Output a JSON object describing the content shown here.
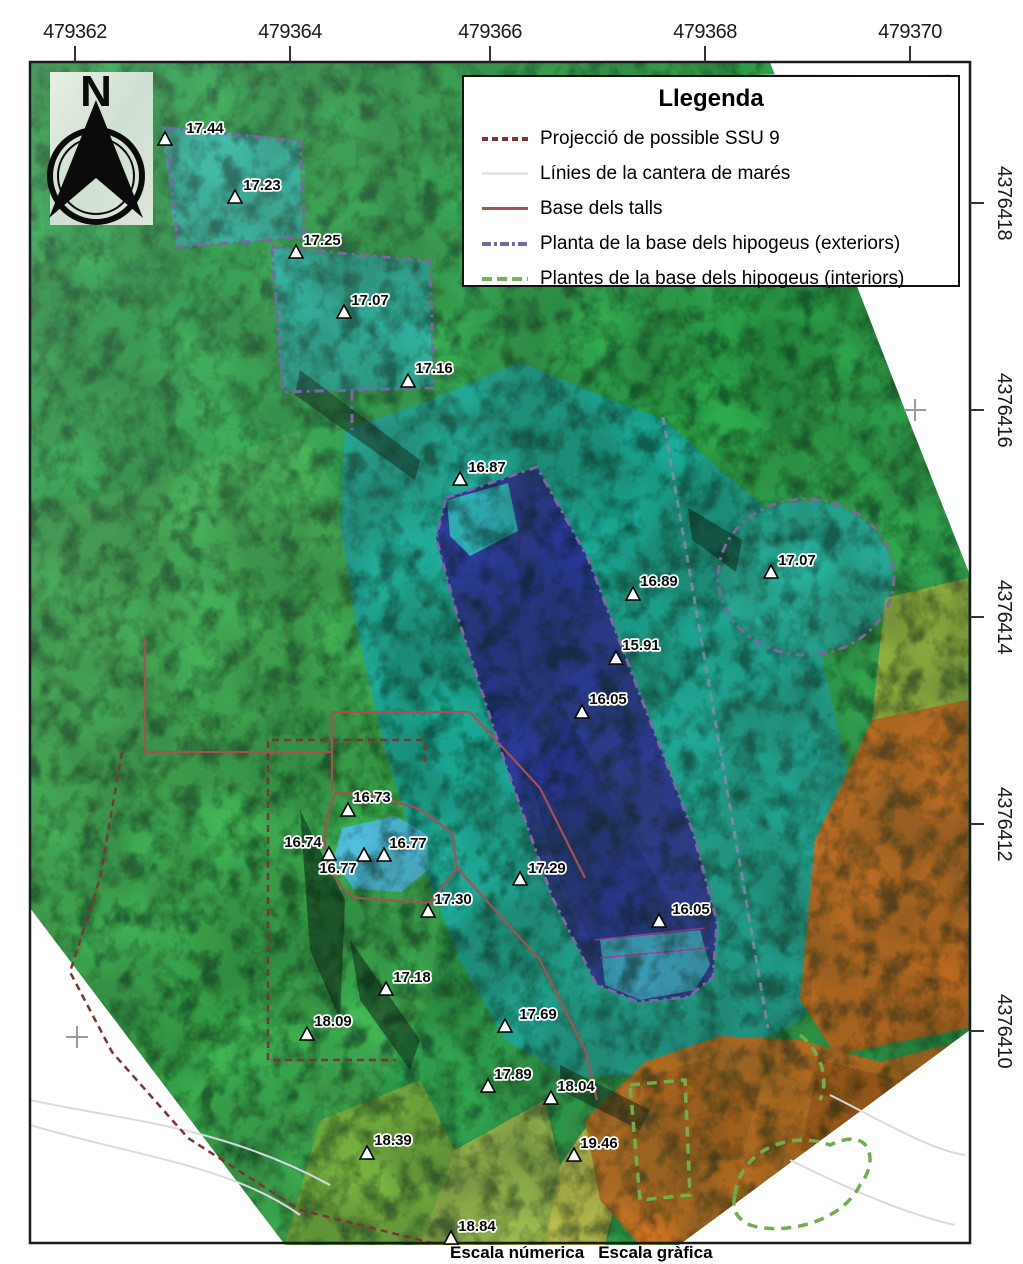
{
  "map": {
    "north_label": "N",
    "caption": {
      "numeric_scale": "Escala númerica",
      "graphic_scale": "Escala gràfica"
    }
  },
  "legend": {
    "title": "Llegenda",
    "items": [
      {
        "label": "Projecció de possible SSU 9",
        "style": "dashed",
        "color": "#7e3434"
      },
      {
        "label": "Línies de la cantera de marés",
        "style": "solid",
        "color": "#e2e2ea"
      },
      {
        "label": "Base dels talls",
        "style": "solid",
        "color": "#a05454"
      },
      {
        "label": "Planta de la base dels hipogeus (exteriors)",
        "style": "dashdot",
        "color": "#7b68a0"
      },
      {
        "label": "Plantes de la base dels hipogeus (interiors)",
        "style": "longdash",
        "color": "#76b35a"
      }
    ]
  },
  "axes": {
    "top": [
      {
        "label": "479362",
        "x": 75
      },
      {
        "label": "479364",
        "x": 290
      },
      {
        "label": "479366",
        "x": 490
      },
      {
        "label": "479368",
        "x": 705
      },
      {
        "label": "479370",
        "x": 910
      }
    ],
    "right": [
      {
        "label": "4376418",
        "y": 203
      },
      {
        "label": "4376416",
        "y": 410
      },
      {
        "label": "4376414",
        "y": 617
      },
      {
        "label": "4376412",
        "y": 824
      },
      {
        "label": "4376410",
        "y": 1031
      }
    ],
    "crosses": [
      {
        "x": 915,
        "y": 410
      },
      {
        "x": 77,
        "y": 1037
      }
    ]
  },
  "elevation_points": [
    {
      "value": "17.44",
      "tx": 165,
      "ty": 140,
      "lx": 205,
      "ly": 128
    },
    {
      "value": "17.23",
      "tx": 235,
      "ty": 198,
      "lx": 262,
      "ly": 185
    },
    {
      "value": "17.25",
      "tx": 296,
      "ty": 253,
      "lx": 322,
      "ly": 240
    },
    {
      "value": "17.07",
      "tx": 344,
      "ty": 313,
      "lx": 370,
      "ly": 300
    },
    {
      "value": "17.16",
      "tx": 408,
      "ty": 382,
      "lx": 434,
      "ly": 368
    },
    {
      "value": "16.87",
      "tx": 460,
      "ty": 480,
      "lx": 487,
      "ly": 467
    },
    {
      "value": "16.89",
      "tx": 633,
      "ty": 595,
      "lx": 659,
      "ly": 581
    },
    {
      "value": "17.07",
      "tx": 771,
      "ty": 573,
      "lx": 797,
      "ly": 560
    },
    {
      "value": "15.91",
      "tx": 616,
      "ty": 659,
      "lx": 641,
      "ly": 645
    },
    {
      "value": "16.05",
      "tx": 582,
      "ty": 713,
      "lx": 608,
      "ly": 699
    },
    {
      "value": "16.73",
      "tx": 348,
      "ty": 811,
      "lx": 372,
      "ly": 797
    },
    {
      "value": "16.74",
      "tx": 329,
      "ty": 855,
      "lx": 303,
      "ly": 842
    },
    {
      "value": "16.77",
      "tx": 384,
      "ty": 856,
      "lx": 408,
      "ly": 843
    },
    {
      "value": "16.77",
      "tx": 364,
      "ty": 856,
      "lx": 338,
      "ly": 868
    },
    {
      "value": "17.29",
      "tx": 520,
      "ty": 880,
      "lx": 547,
      "ly": 868
    },
    {
      "value": "17.30",
      "tx": 428,
      "ty": 912,
      "lx": 453,
      "ly": 899
    },
    {
      "value": "16.05",
      "tx": 659,
      "ty": 922,
      "lx": 691,
      "ly": 909
    },
    {
      "value": "17.18",
      "tx": 386,
      "ty": 990,
      "lx": 412,
      "ly": 977
    },
    {
      "value": "18.09",
      "tx": 307,
      "ty": 1035,
      "lx": 333,
      "ly": 1021
    },
    {
      "value": "17.69",
      "tx": 505,
      "ty": 1027,
      "lx": 538,
      "ly": 1014
    },
    {
      "value": "17.89",
      "tx": 488,
      "ty": 1087,
      "lx": 513,
      "ly": 1074
    },
    {
      "value": "18.04",
      "tx": 551,
      "ty": 1099,
      "lx": 576,
      "ly": 1086
    },
    {
      "value": "18.39",
      "tx": 367,
      "ty": 1154,
      "lx": 393,
      "ly": 1140
    },
    {
      "value": "19.46",
      "tx": 574,
      "ty": 1156,
      "lx": 599,
      "ly": 1143
    },
    {
      "value": "18.84",
      "tx": 451,
      "ty": 1239,
      "lx": 477,
      "ly": 1226
    }
  ],
  "colors": {
    "terrain_green": "#2fae4e",
    "terrain_teal": "#1db3a0",
    "pit_deep_blue": "#2c38a0",
    "pond_blue": "#53c3e5",
    "terrain_orange": "#d9731d",
    "terrain_yellow": "#d6d44e",
    "ssu9_line": "#7e3434",
    "talls_line": "#a05454",
    "hipogeu_ext_line": "#7b68a0",
    "hipogeu_int_line": "#76b35a",
    "cantera_line": "#e2e2ea"
  }
}
